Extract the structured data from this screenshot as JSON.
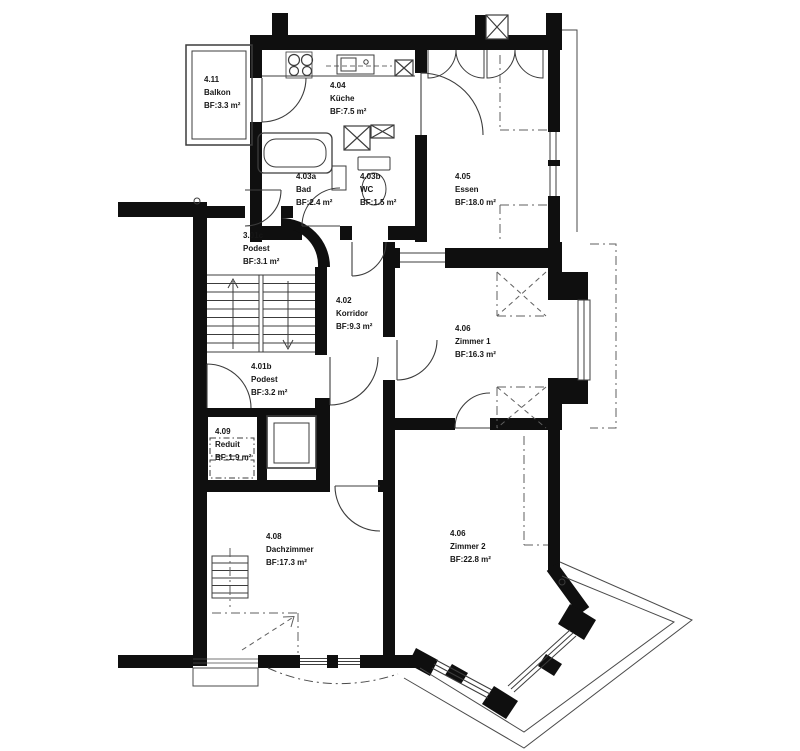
{
  "plan": {
    "rooms": [
      {
        "number": "4.11",
        "name": "Balkon",
        "area": "BF:3.3 m²"
      },
      {
        "number": "4.04",
        "name": "Küche",
        "area": "BF:7.5 m²"
      },
      {
        "number": "4.03a",
        "name": "Bad",
        "area": "BF:2.4 m²"
      },
      {
        "number": "4.03b",
        "name": "WC",
        "area": "BF:1.5 m²"
      },
      {
        "number": "4.05",
        "name": "Essen",
        "area": "BF:18.0 m²"
      },
      {
        "number": "3.01c",
        "name": "Podest",
        "area": "BF:3.1 m²"
      },
      {
        "number": "4.02",
        "name": "Korridor",
        "area": "BF:9.3 m²"
      },
      {
        "number": "4.06",
        "name": "Zimmer 1",
        "area": "BF:16.3 m²"
      },
      {
        "number": "4.01b",
        "name": "Podest",
        "area": "BF:3.2 m²"
      },
      {
        "number": "4.09",
        "name": "Reduit",
        "area": "BF:1.9 m²"
      },
      {
        "number": "4.08",
        "name": "Dachzimmer",
        "area": "BF:17.3 m²"
      },
      {
        "number": "4.06",
        "name": "Zimmer 2",
        "area": "BF:22.8 m²"
      }
    ],
    "colors": {
      "wall": "#0f0f0f",
      "line": "#3c3c3c",
      "dash": "#5f5f5f",
      "background": "#ffffff"
    }
  }
}
